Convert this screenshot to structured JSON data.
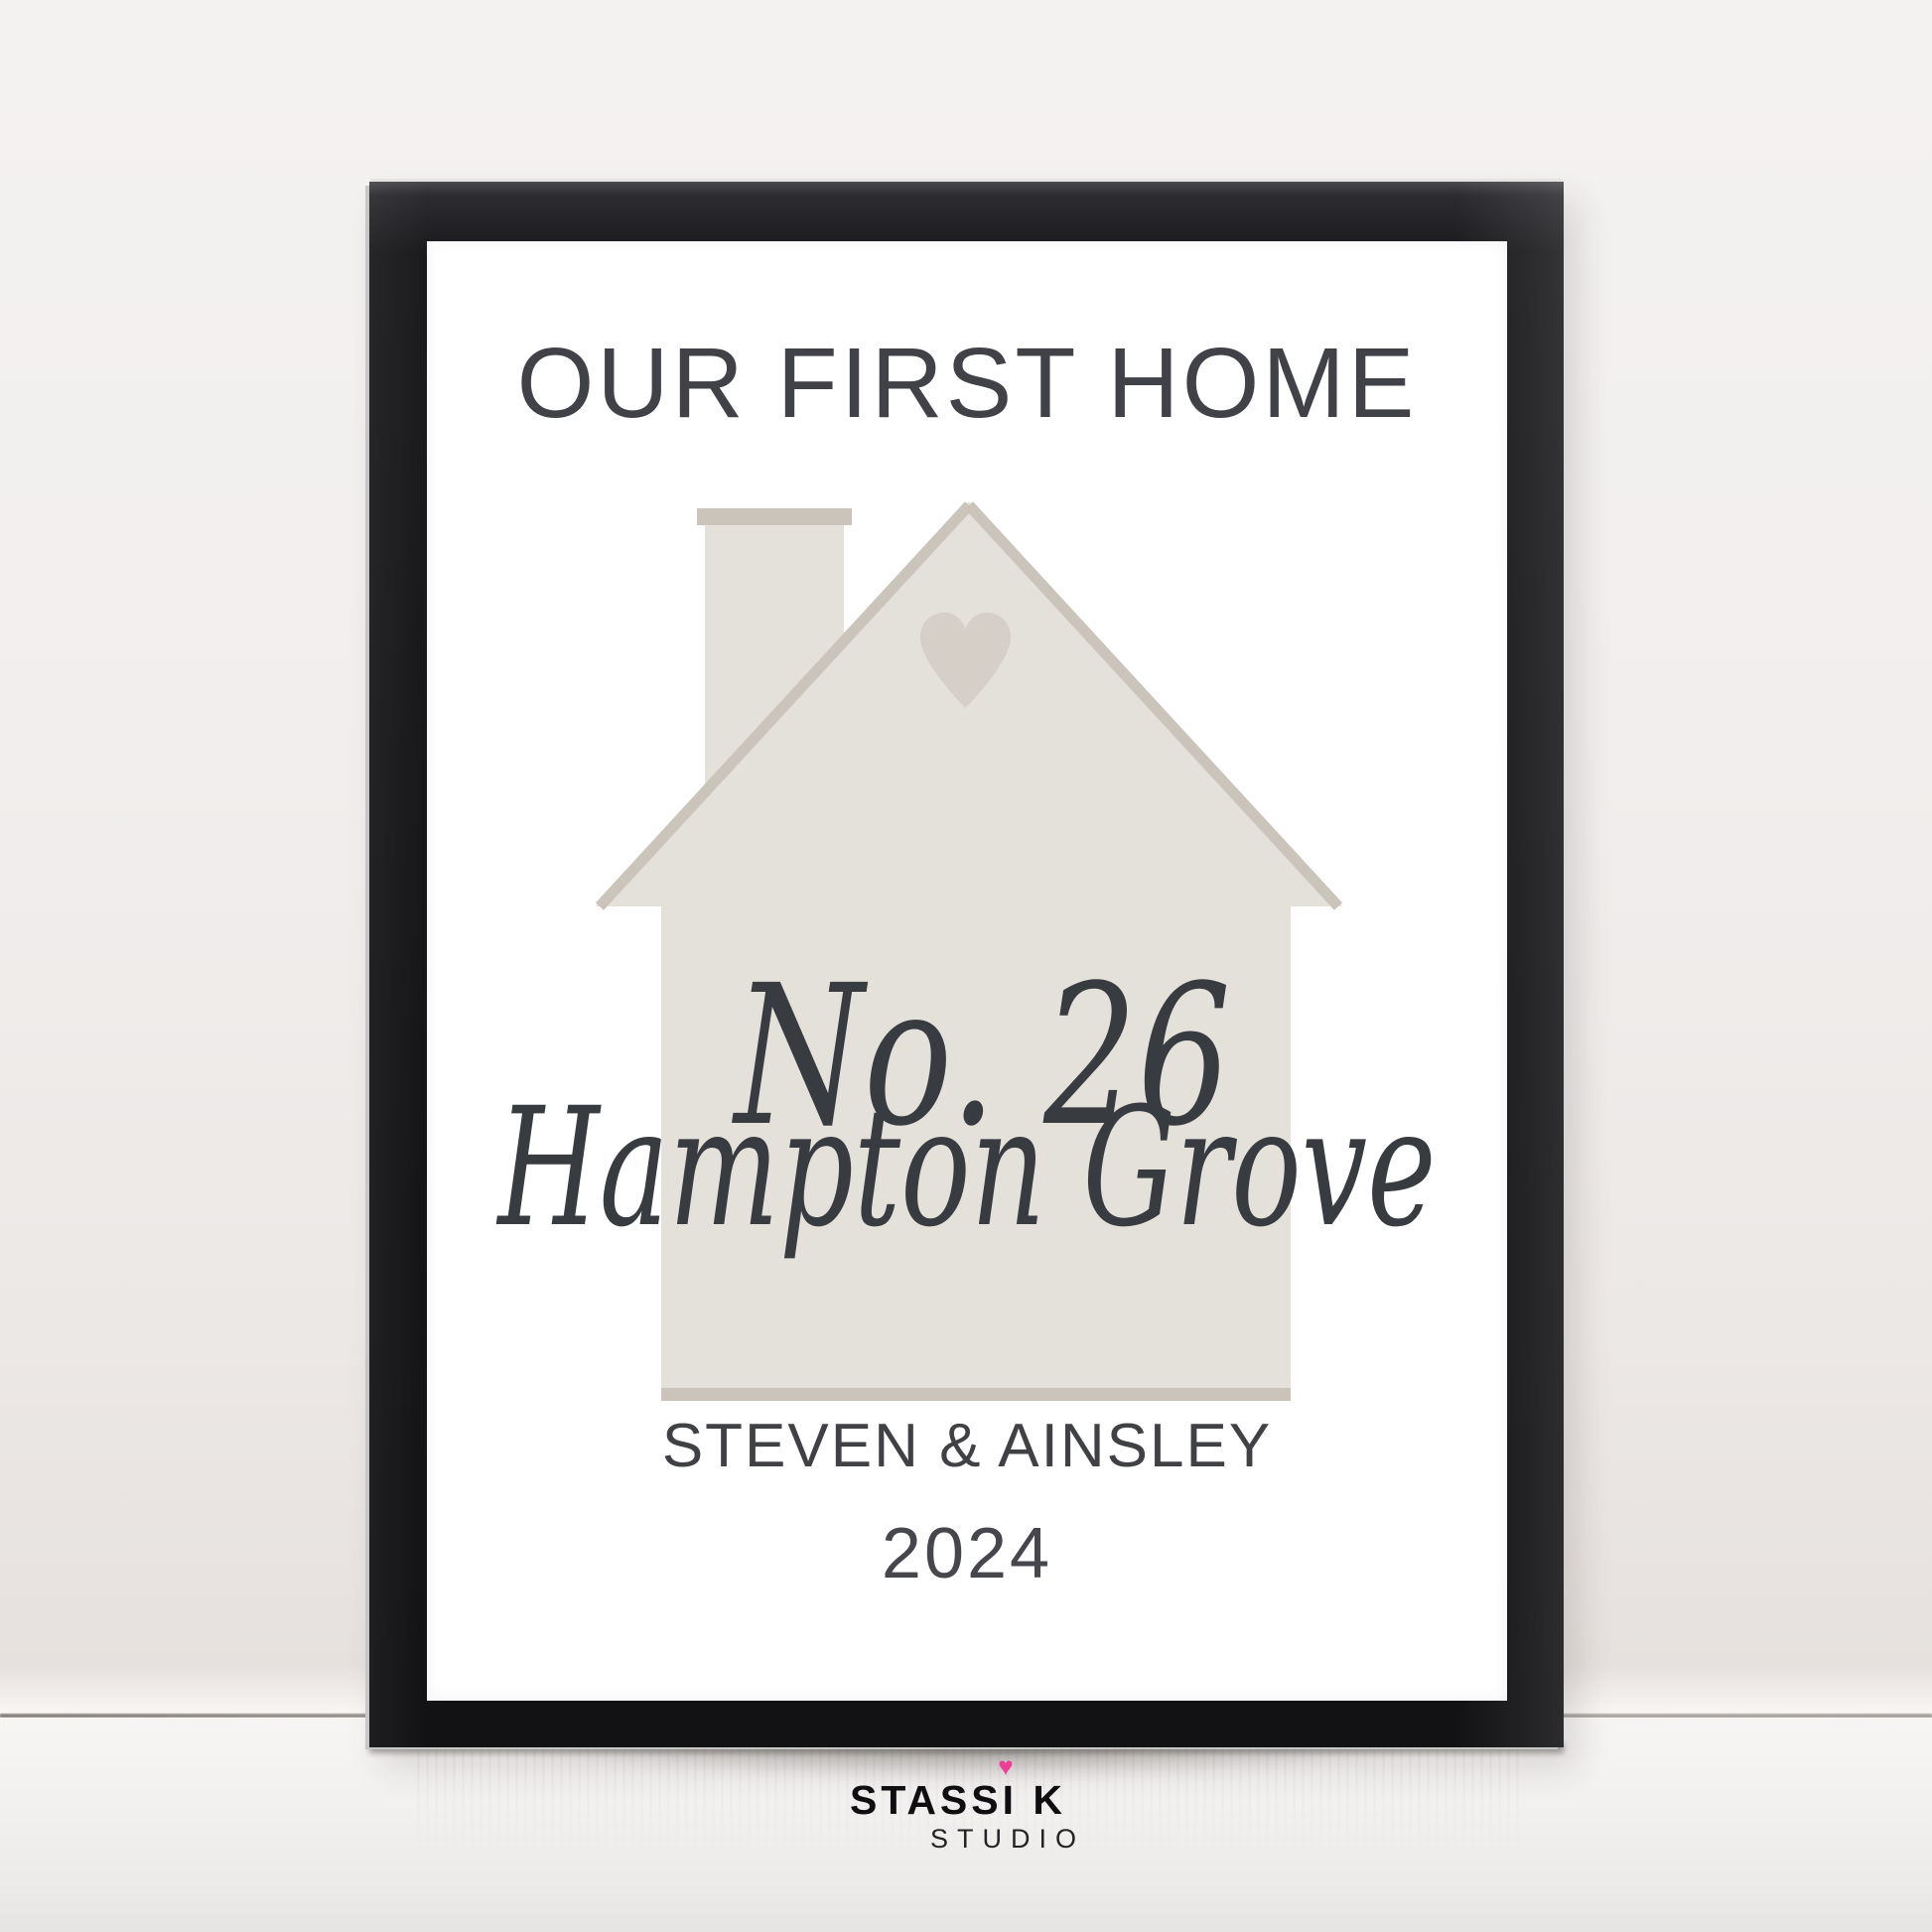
{
  "print": {
    "title": "OUR FIRST HOME",
    "house_number": "No. 26",
    "street_name": "Hampton Grove",
    "owners": "STEVEN & AINSLEY",
    "year": "2024"
  },
  "house_graphic": {
    "fill": "#e4e0da",
    "accent": "#cbc4bb",
    "heart": "#d6cfc8"
  },
  "brand": {
    "name": "STASSI K",
    "subtitle": "STUDIO",
    "heart_icon": "♥",
    "heart_color": "#ee3f97"
  },
  "palette": {
    "frame": "#1a1a1c",
    "print_background": "#ffffff",
    "text": "#3f4145",
    "wall": "#f0edec",
    "surface": "#f5f3f2"
  }
}
